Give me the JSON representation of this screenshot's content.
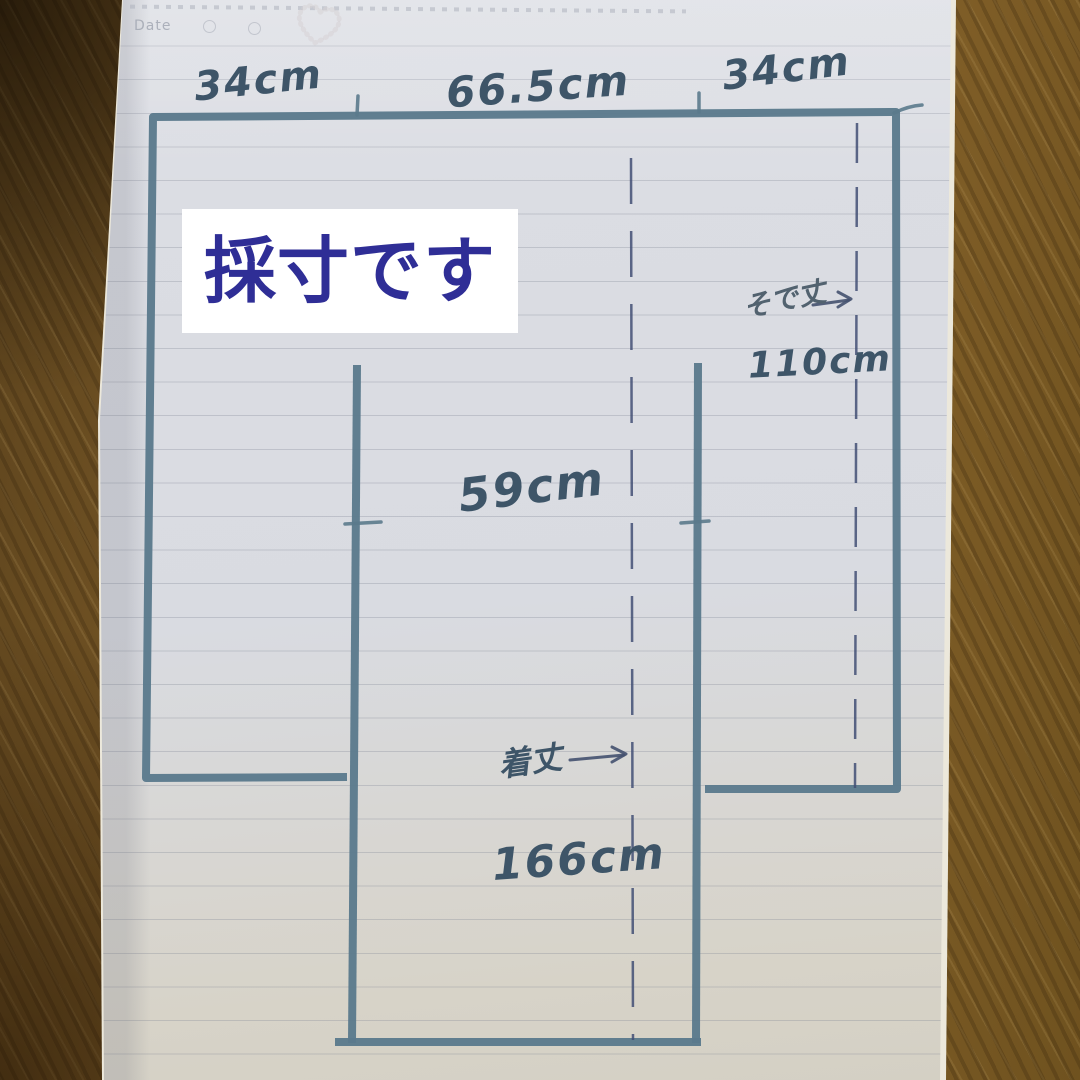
{
  "caption": {
    "text": "採寸です"
  },
  "notebook_header": {
    "date_label": "Date"
  },
  "measurements": {
    "shoulder_left": "34cm",
    "shoulder_width": "66.5cm",
    "shoulder_right": "34cm",
    "body_width": "59cm",
    "sleeve_length_label": "そで丈",
    "sleeve_length_arrow": "→",
    "sleeve_length_value": "110cm",
    "body_length_label": "着丈",
    "body_length_arrow": "→",
    "body_length_value": "166cm"
  },
  "colors": {
    "marker": "#5b7a8c",
    "pen": "#424f74",
    "pen-dark": "#44516f",
    "ink": "#3e5568",
    "caption-ink": "#2f2e96",
    "caption-bg": "#ffffff",
    "paper": "#d9dbe1",
    "wood": "#7b5a27"
  }
}
